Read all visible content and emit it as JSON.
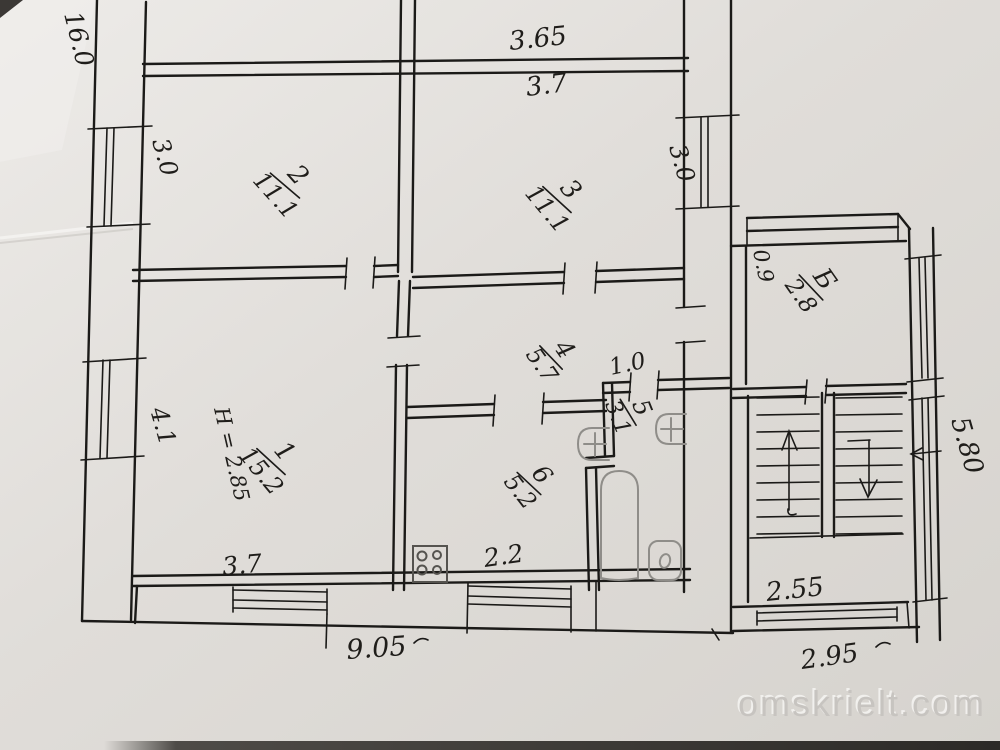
{
  "watermark": "omskrielt.com",
  "rooms": [
    {
      "number": "1",
      "area": "15.2",
      "height_note": "H = 2.85"
    },
    {
      "number": "2",
      "area": "11.1"
    },
    {
      "number": "3",
      "area": "11.1"
    },
    {
      "number": "4",
      "area": "5.7"
    },
    {
      "number": "5",
      "area": "3.1"
    },
    {
      "number": "6",
      "area": "5.2"
    },
    {
      "number": "Б",
      "area": "2.8"
    }
  ],
  "dimensions": {
    "left_total": "16.0",
    "top_outer": "3.65",
    "top_inner": "3.7",
    "left_upper_window": "3.0",
    "right_window": "3.0",
    "balcony_side": "0.9",
    "left_lower_window": "4.1",
    "room1_bottom": "3.7",
    "kitchen_bottom": "2.2",
    "wc_door": "1.0",
    "bottom_total": "9.05",
    "stair_width": "2.55",
    "annex_bottom": "2.95",
    "annex_side": "5.80"
  },
  "fixtures": [
    "stove",
    "bathtub",
    "toilet",
    "wash-basin",
    "wash-basin"
  ],
  "stairs": {
    "flights": 2,
    "up_arrow": "up",
    "down_arrow": "down"
  }
}
